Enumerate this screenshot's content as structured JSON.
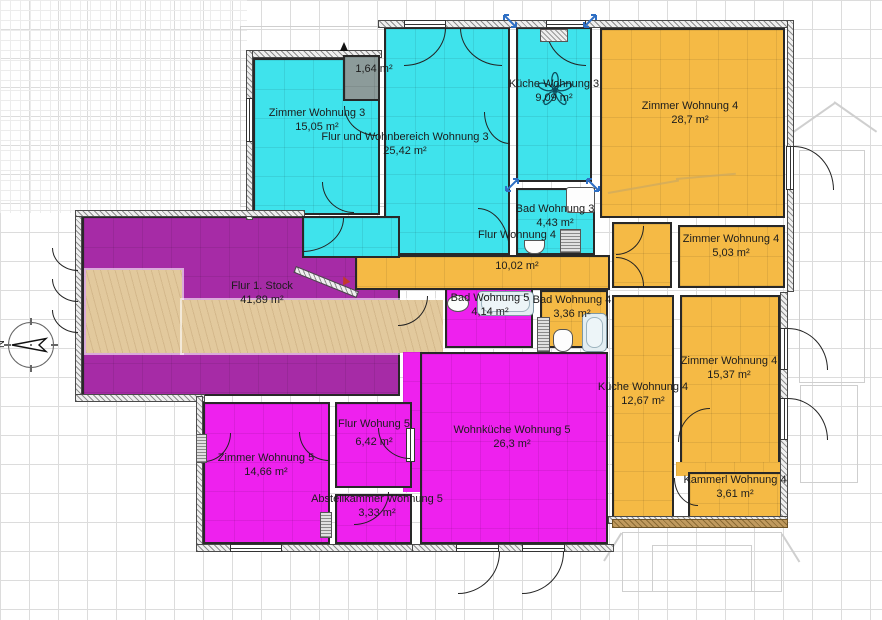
{
  "compass": {
    "label": "N"
  },
  "colors": {
    "wohnung3": "#3fe3ec",
    "wohnung4": "#f5ba45",
    "wohnung5": "#ee21ee",
    "flur_stock": "#a62ba6",
    "closet_gray": "#8c9b9a",
    "wood_floor": "#e2c99d",
    "balcony_wood": "#c09a5e",
    "selection_blue": "#2e6fc4"
  },
  "rooms": [
    {
      "name": "Zimmer Wohnung 3",
      "area": "15,05 m²",
      "apartment": "Wohnung 3",
      "color": "#3fe3ec"
    },
    {
      "name": "",
      "area": "1,64 m²",
      "apartment": "",
      "color": "#8c9b9a"
    },
    {
      "name": "Flur und Wohnbereich Wohnung 3",
      "area": "25,42 m²",
      "apartment": "Wohnung 3",
      "color": "#3fe3ec"
    },
    {
      "name": "Küche Wohnung 3",
      "area": "9,09 m²",
      "apartment": "Wohnung 3",
      "color": "#3fe3ec"
    },
    {
      "name": "Bad Wohnung 3",
      "area": "4,43 m²",
      "apartment": "Wohnung 3",
      "color": "#3fe3ec"
    },
    {
      "name": "Zimmer Wohnung 4",
      "area": "28,7 m²",
      "apartment": "Wohnung 4",
      "color": "#f5ba45"
    },
    {
      "name": "Flur Wohnung 4",
      "area": "10,02 m²",
      "apartment": "Wohnung 4",
      "color": "#f5ba45"
    },
    {
      "name": "Zimmer Wohnung 4",
      "area": "5,03 m²",
      "apartment": "Wohnung 4",
      "color": "#f5ba45"
    },
    {
      "name": "Zimmer Wohnung 4",
      "area": "15,37 m²",
      "apartment": "Wohnung 4",
      "color": "#f5ba45"
    },
    {
      "name": "Küche Wohnung 4",
      "area": "12,67 m²",
      "apartment": "Wohnung 4",
      "color": "#f5ba45"
    },
    {
      "name": "Bad Wohnung 4",
      "area": "3,36 m²",
      "apartment": "Wohnung 4",
      "color": "#f5ba45"
    },
    {
      "name": "Kammerl Wohnung 4",
      "area": "3,61 m²",
      "apartment": "Wohnung 4",
      "color": "#f5ba45"
    },
    {
      "name": "Flur 1. Stock",
      "area": "41,89 m²",
      "apartment": "Gemeinschaft",
      "color": "#a62ba6"
    },
    {
      "name": "Bad Wohnung 5",
      "area": "4,14 m²",
      "apartment": "Wohnung 5",
      "color": "#ee21ee"
    },
    {
      "name": "Flur Wohung 5",
      "area": "6,42 m²",
      "apartment": "Wohnung 5",
      "color": "#ee21ee"
    },
    {
      "name": "Wohnküche Wohnung 5",
      "area": "26,3 m²",
      "apartment": "Wohnung 5",
      "color": "#ee21ee"
    },
    {
      "name": "Zimmer Wohnung 5",
      "area": "14,66 m²",
      "apartment": "Wohnung 5",
      "color": "#ee21ee"
    },
    {
      "name": "Abstellkammer Wohnung 5",
      "area": "3,33 m²",
      "apartment": "Wohnung 5",
      "color": "#ee21ee"
    }
  ]
}
